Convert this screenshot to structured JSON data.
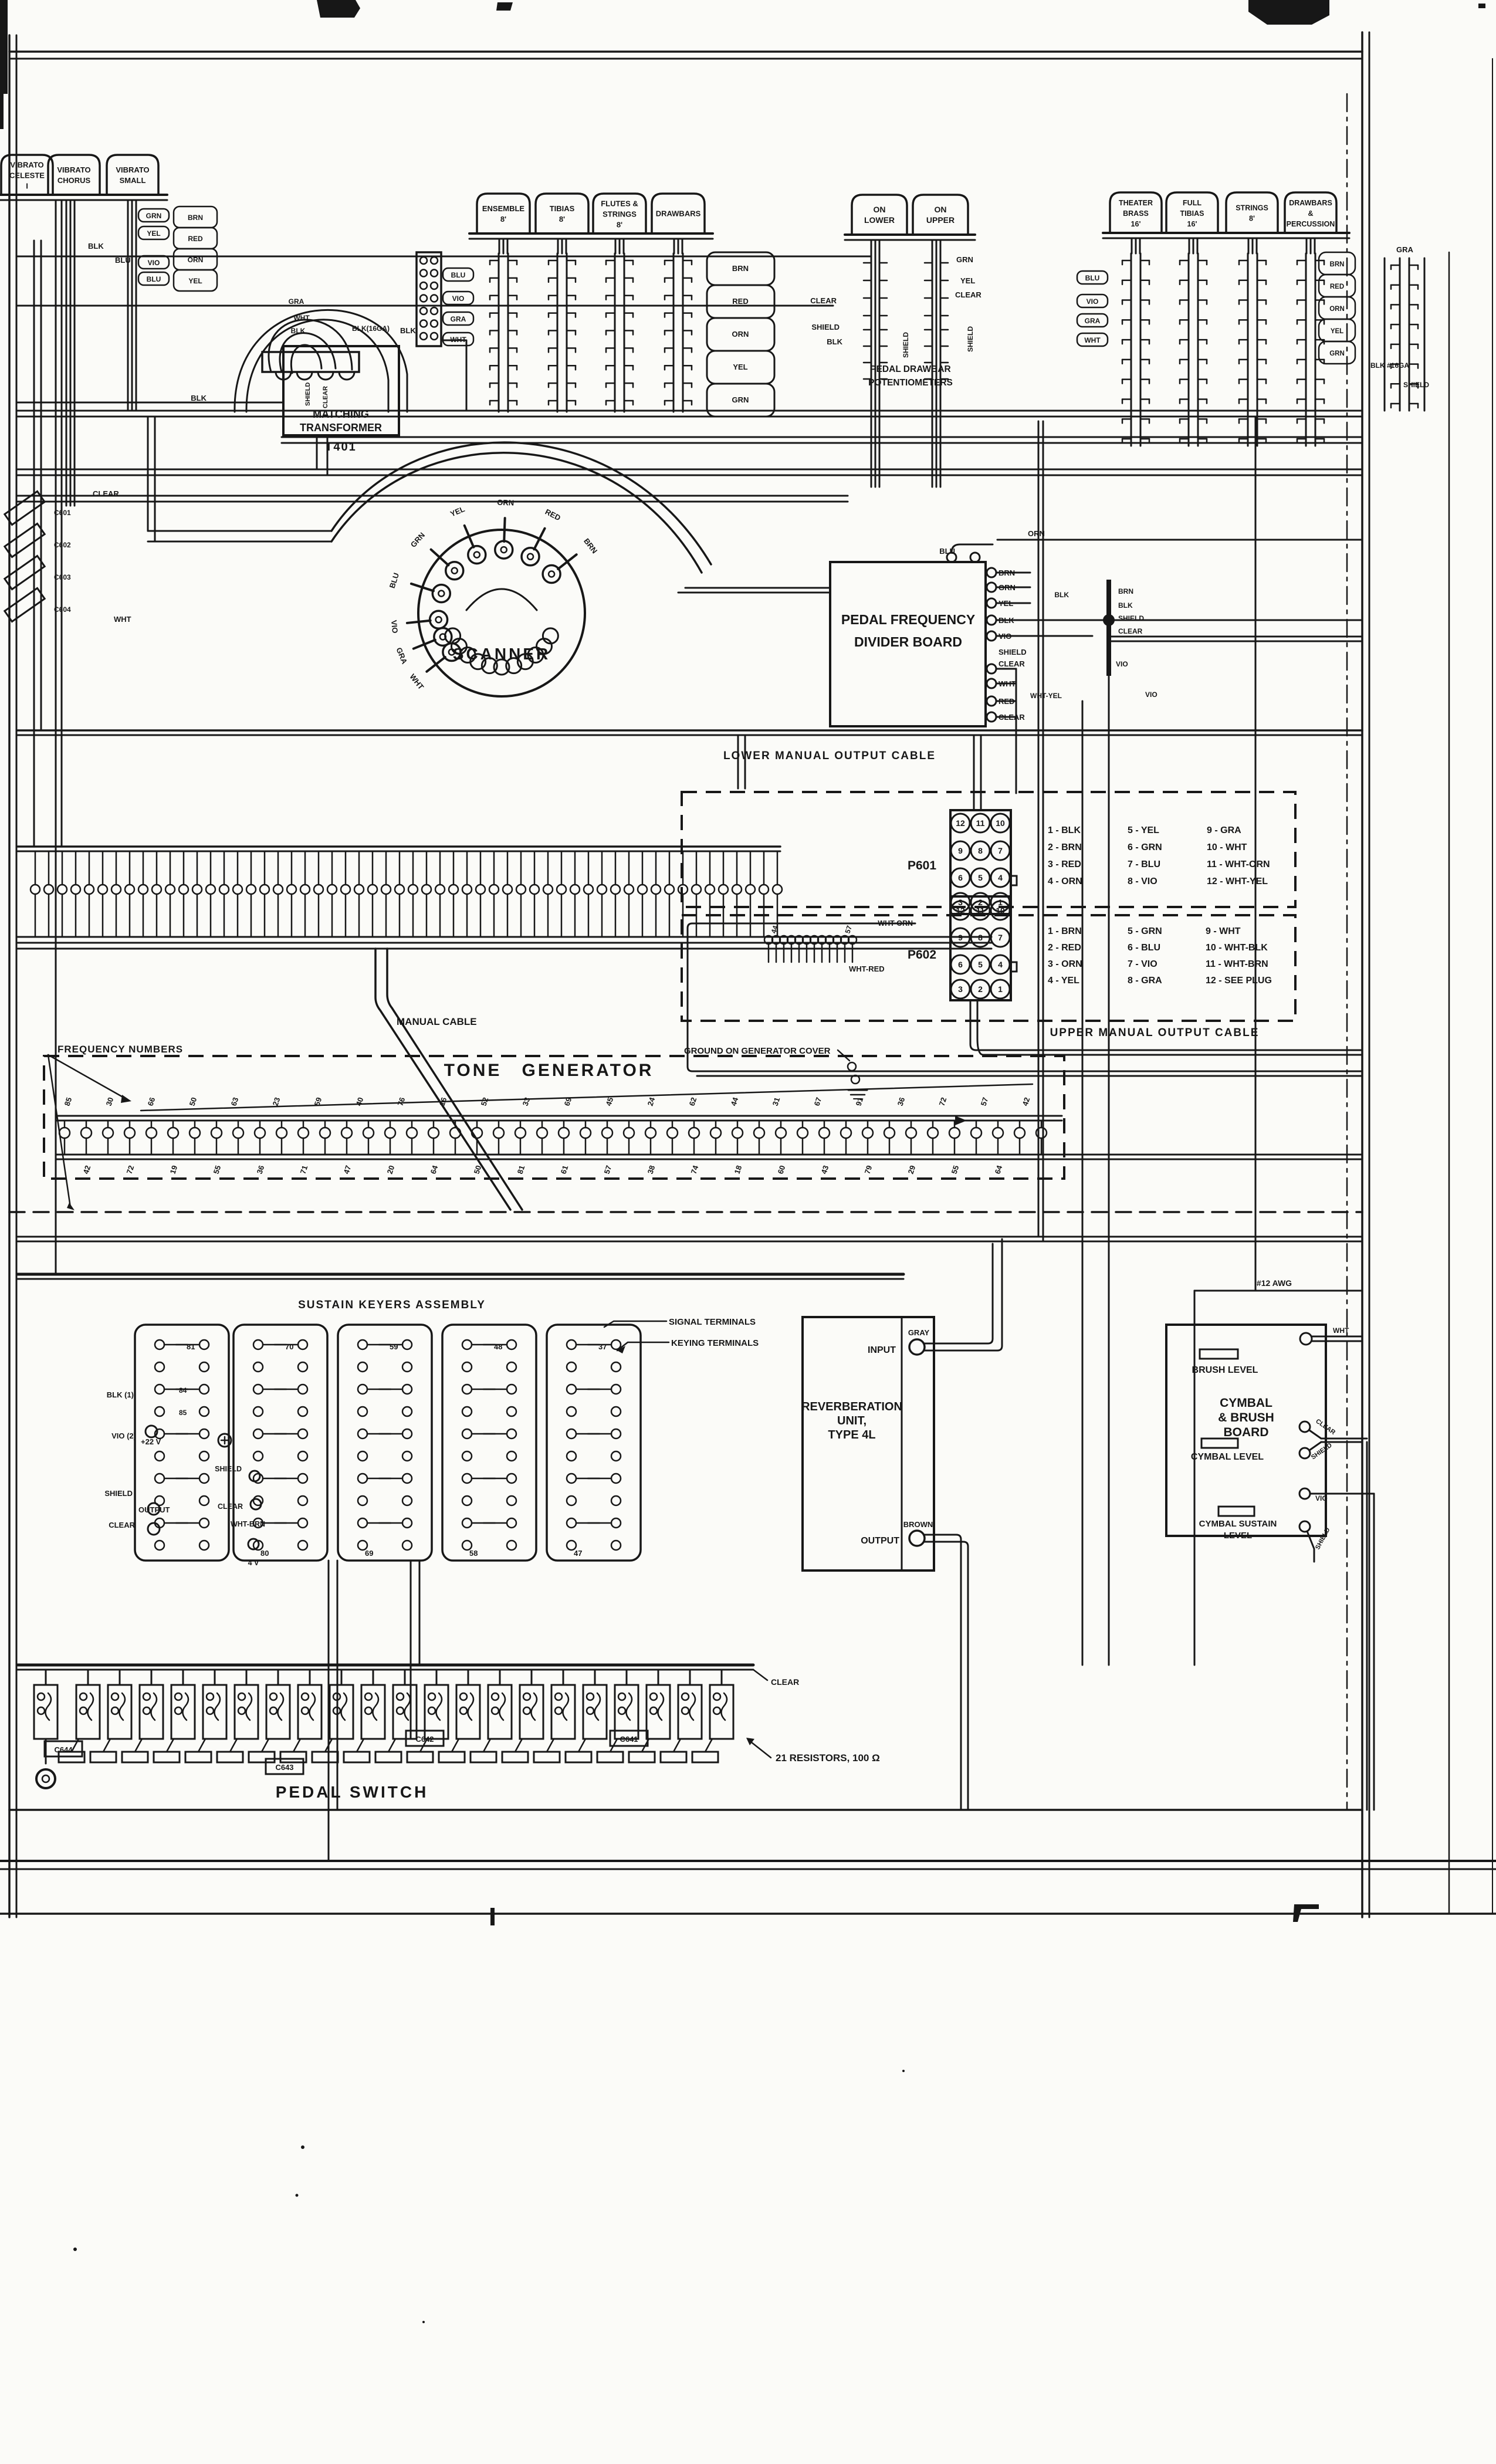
{
  "stop_tabs": {
    "left": {
      "labels": [
        [
          "VIBRATO",
          "CELESTE",
          "I"
        ],
        [
          "VIBRATO",
          "CHORUS"
        ],
        [
          "VIBRATO",
          "SMALL"
        ]
      ]
    },
    "middle": {
      "labels": [
        [
          "ENSEMBLE",
          "8'"
        ],
        [
          "TIBIAS",
          "8'"
        ],
        [
          "FLUTES &",
          "STRINGS",
          "8'"
        ],
        [
          "DRAWBARS"
        ]
      ]
    },
    "pedal": {
      "labels": [
        [
          "ON",
          "LOWER"
        ],
        [
          "ON",
          "UPPER"
        ]
      ],
      "caption1": "PEDAL DRAWBAR",
      "caption2": "POTENTIOMETERS"
    },
    "right": {
      "labels": [
        [
          "THEATER",
          "BRASS",
          "16'"
        ],
        [
          "FULL",
          "TIBIAS",
          "16'"
        ],
        [
          "STRINGS",
          "8'"
        ],
        [
          "DRAWBARS",
          "&",
          "PERCUSSION"
        ]
      ]
    }
  },
  "wires": {
    "mid_left": [
      "BLU",
      "VIO",
      "GRA",
      "WHT"
    ],
    "mid_right": [
      "BRN",
      "RED",
      "ORN",
      "YEL",
      "GRN"
    ],
    "right_left": [
      "BLU",
      "VIO",
      "GRA",
      "WHT"
    ],
    "right_right": [
      "BRN",
      "RED",
      "ORN",
      "YEL",
      "GRN"
    ],
    "left_steps": [
      "GRN",
      "YEL",
      "VIO",
      "BLU"
    ],
    "left_ladder": [
      "BRN",
      "RED",
      "ORN",
      "YEL"
    ],
    "left_misc": [
      "BLK",
      "BLU"
    ],
    "pedal_left": [
      "CLEAR",
      "SHIELD",
      "BLK"
    ],
    "pedal_right": [
      "GRN",
      "YEL",
      "CLEAR"
    ],
    "pedal_rot": [
      "SHIELD",
      "SHIELD"
    ],
    "far_right": [
      "GRA",
      "BLK #16GA",
      "SHIELD"
    ]
  },
  "transformer": {
    "name1": "MATCHING",
    "name2": "TRANSFORMER",
    "part": "T401",
    "arc_labels": [
      "GRA",
      "WHT",
      "BLK"
    ],
    "right_labels": [
      "BLK(16GA)",
      "BLK"
    ],
    "left_label": "BLK",
    "rot_labels": [
      "SHIELD",
      "CLEAR"
    ]
  },
  "scanner": {
    "title": "SCANNER",
    "left_terminals": [
      "WHT",
      "GRA",
      "VIO"
    ],
    "terminals": [
      "BLU",
      "GRN",
      "YEL",
      "ORN",
      "RED",
      "BRN"
    ]
  },
  "divider": {
    "title1": "PEDAL FREQUENCY",
    "title2": "DIVIDER BOARD",
    "terminals": [
      "BRN",
      "GRN",
      "YEL",
      "BLK",
      "VIO",
      "SHIELD",
      "CLEAR",
      "WHT",
      "RED",
      "CLEAR"
    ],
    "top_labels": [
      "BLU",
      "ORN"
    ],
    "junction_labels": [
      "BLK",
      "BRN",
      "BLK",
      "SHIELD",
      "CLEAR",
      "VIO",
      "WHT-YEL",
      "VIO"
    ]
  },
  "p601": {
    "name": "P601",
    "pins": [
      "12",
      "11",
      "10",
      "9",
      "8",
      "7",
      "6",
      "5",
      "4",
      "3",
      "2",
      "1"
    ],
    "legend": [
      "1 - BLK",
      "2 - BRN",
      "3 - RED",
      "4 - ORN",
      "5 - YEL",
      "6 - GRN",
      "7 - BLU",
      "8 - VIO",
      "9 - GRA",
      "10 - WHT",
      "11 - WHT-ORN",
      "12 - WHT-YEL"
    ]
  },
  "p602": {
    "name": "P602",
    "wire": "WHT-ORN",
    "pins": [
      "12",
      "11",
      "10",
      "9",
      "8",
      "7",
      "6",
      "5",
      "4",
      "3",
      "2",
      "1"
    ],
    "legend": [
      "1 - BRN",
      "2 - RED",
      "3 - ORN",
      "4 - YEL",
      "5 - GRN",
      "6 - BLU",
      "7 - VIO",
      "8 - GRA",
      "9 - WHT",
      "10 - WHT-BLK",
      "11 - WHT-BRN",
      "12 - SEE PLUG"
    ]
  },
  "cables": {
    "lower": "LOWER MANUAL OUTPUT CABLE",
    "upper": "UPPER MANUAL OUTPUT CABLE",
    "manual": "MANUAL CABLE",
    "wht_red": "WHT-RED"
  },
  "tone_generator": {
    "title1": "TONE",
    "title2": "GENERATOR",
    "freq_label": "FREQUENCY NUMBERS",
    "ground": "GROUND ON GENERATOR COVER",
    "numbers_top": [
      "85",
      "30",
      "66",
      "50",
      "63",
      "23",
      "59",
      "40",
      "76",
      "16",
      "52",
      "33",
      "69",
      "45",
      "24",
      "62",
      "44",
      "31",
      "67",
      "91",
      "36",
      "72",
      "57",
      "42"
    ],
    "numbers_bottom": [
      "42",
      "72",
      "19",
      "55",
      "36",
      "71",
      "47",
      "20",
      "64",
      "50",
      "81",
      "61",
      "57",
      "38",
      "74",
      "18",
      "60",
      "43",
      "79",
      "29",
      "55",
      "64"
    ],
    "cluster_numbers": [
      "44",
      "57"
    ]
  },
  "keyers": {
    "title": "SUSTAIN KEYERS ASSEMBLY",
    "panel_top": [
      "81",
      "70",
      "59",
      "48",
      "37"
    ],
    "panel_bottom": [
      "80",
      "69",
      "58",
      "47"
    ],
    "row_numbers": [
      "84",
      "85"
    ],
    "left_labels": [
      "BLK (1)",
      "VIO (2)",
      "+22 V",
      "SHIELD",
      "OUTPUT",
      "CLEAR"
    ],
    "mid_labels": [
      "SHIELD",
      "CLEAR",
      "WHT-BRN",
      "4 V"
    ],
    "signal": "SIGNAL TERMINALS",
    "keying": "KEYING TERMINALS"
  },
  "reverb": {
    "line1": "REVERBERATION",
    "line2": "UNIT,",
    "line3": "TYPE 4L",
    "input": "INPUT",
    "input_wire": "GRAY",
    "output": "OUTPUT",
    "output_wire": "BROWN"
  },
  "cymbal": {
    "line1": "CYMBAL",
    "line2": "& BRUSH",
    "line3": "BOARD",
    "brush": "BRUSH LEVEL",
    "cymbal": "CYMBAL LEVEL",
    "sustain1": "CYMBAL SUSTAIN",
    "sustain2": "LEVEL",
    "awg": "#12 AWG",
    "term_top": "WHT",
    "term_mid": [
      "CLEAR",
      "SHIELD"
    ],
    "term_vio": "VIO",
    "term_bot": "SHIELD"
  },
  "pedal_switch": {
    "title": "PEDAL SWITCH",
    "resistors": "21 RESISTORS, 100 Ω",
    "clear": "CLEAR",
    "caps": [
      "C644",
      "C643",
      "C642",
      "C641"
    ]
  },
  "left_caps": {
    "labels": [
      "C601",
      "C602",
      "C603",
      "C604"
    ],
    "top": "CLEAR",
    "bottom": "WHT"
  }
}
